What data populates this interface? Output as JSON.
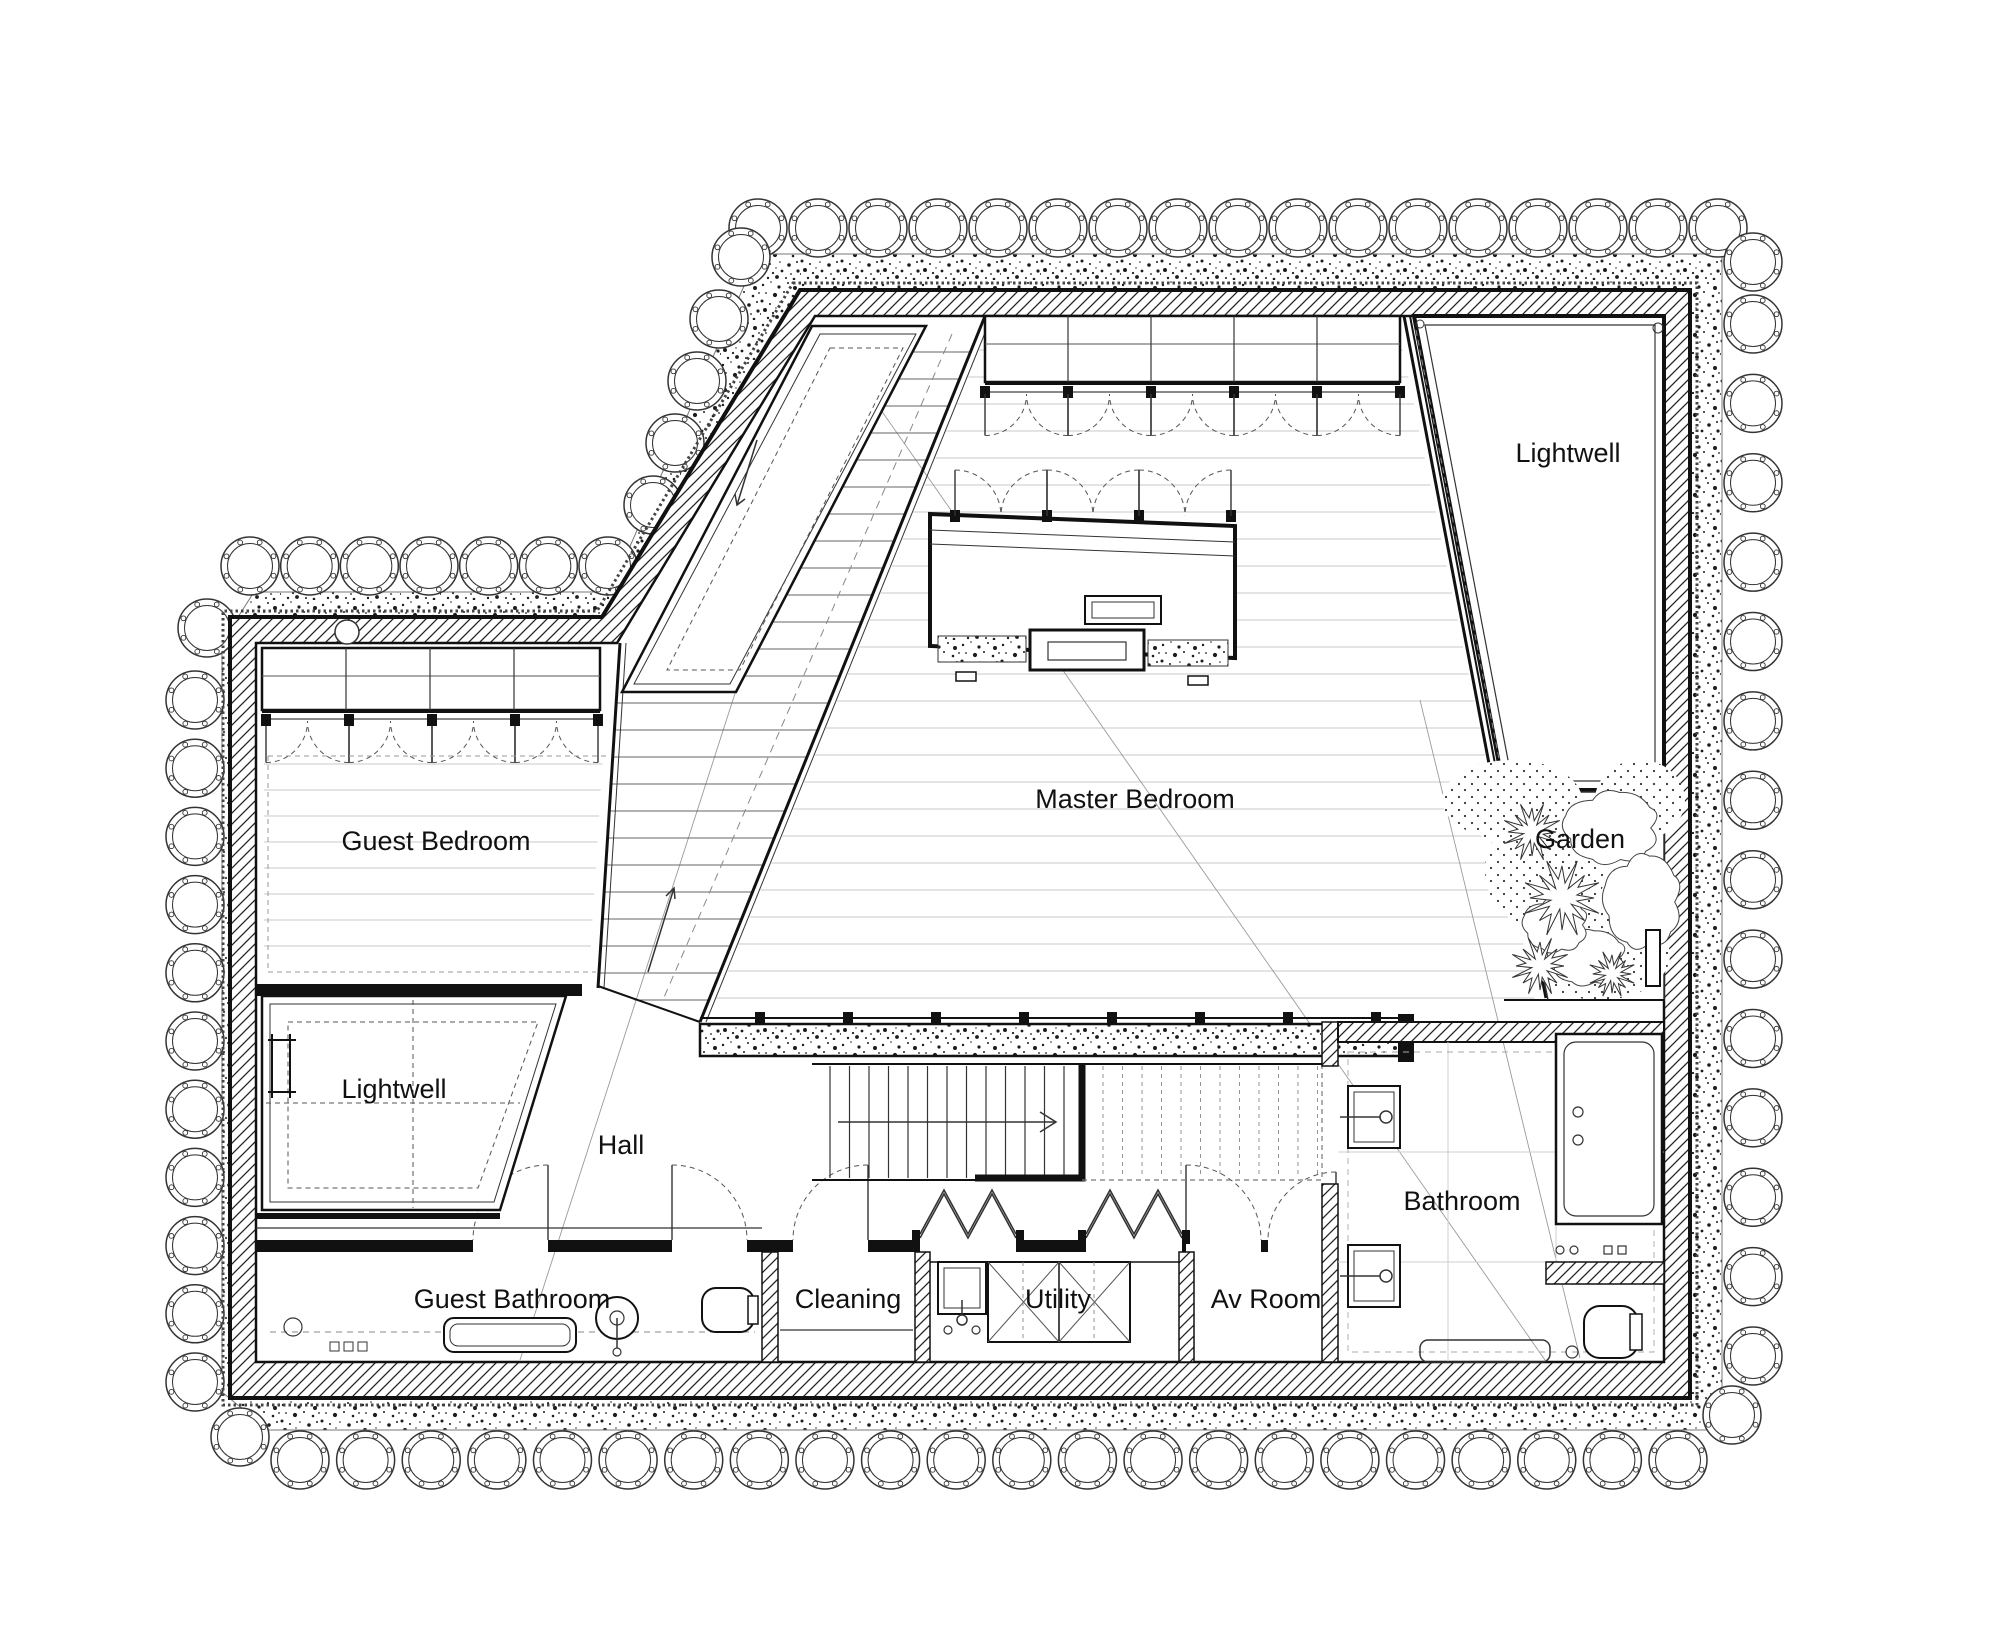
{
  "drawing": {
    "kind": "architectural-floor-plan",
    "rooms": [
      {
        "id": "lightwell-upper",
        "label": "Lightwell"
      },
      {
        "id": "garden",
        "label": "Garden"
      },
      {
        "id": "master-bedroom",
        "label": "Master Bedroom"
      },
      {
        "id": "guest-bedroom",
        "label": "Guest Bedroom"
      },
      {
        "id": "lightwell-lower",
        "label": "Lightwell"
      },
      {
        "id": "hall",
        "label": "Hall"
      },
      {
        "id": "guest-bathroom",
        "label": "Guest Bathroom"
      },
      {
        "id": "cleaning",
        "label": "Cleaning"
      },
      {
        "id": "utility",
        "label": "Utility"
      },
      {
        "id": "av-room",
        "label": "Av Room"
      },
      {
        "id": "bathroom",
        "label": "Bathroom"
      }
    ],
    "colors": {
      "line": "#111111",
      "background": "#ffffff",
      "floor_line": "#c9c9c9",
      "tread_line": "#666666"
    }
  }
}
